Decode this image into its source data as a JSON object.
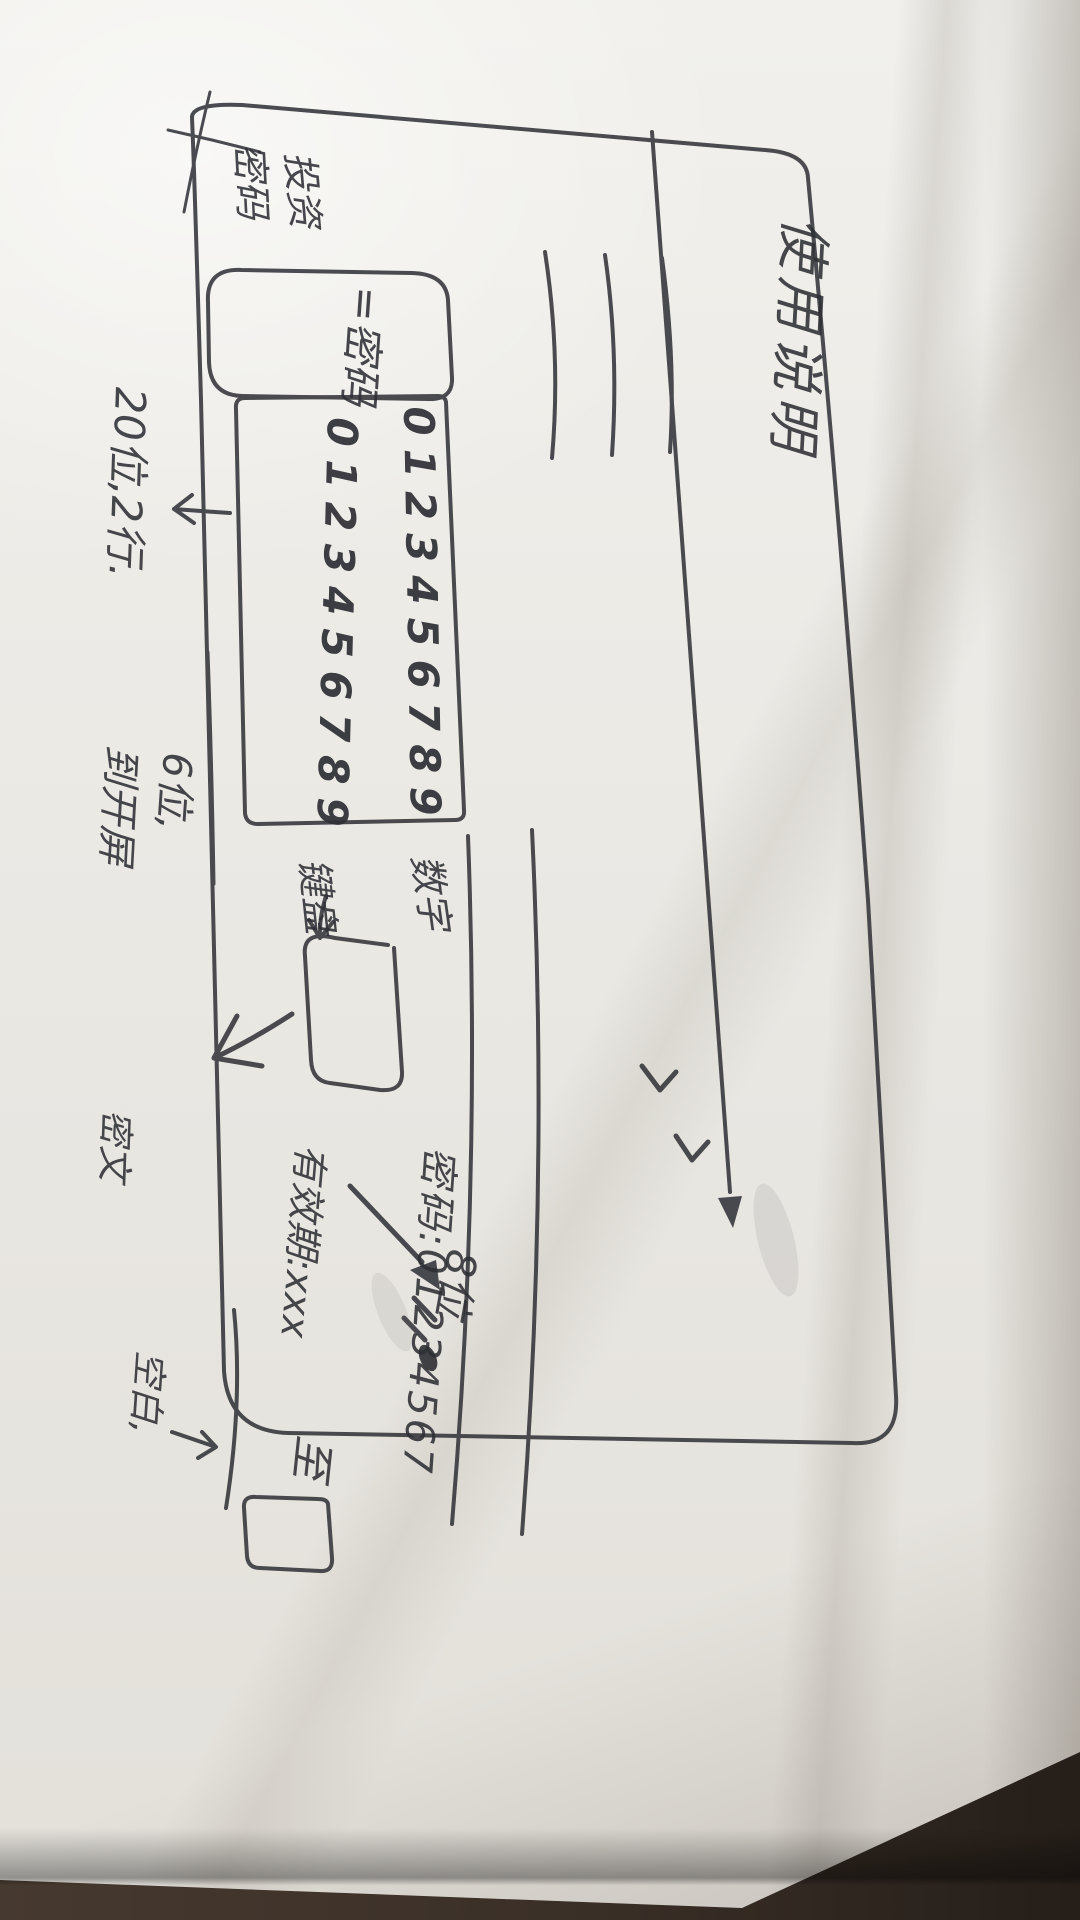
{
  "colors": {
    "floor": "#3a2f27",
    "paper": "#ebe9e4",
    "ink": "#2f3036"
  },
  "sketch": {
    "page_title": "使用说明",
    "content_placeholder_lines": 3,
    "password_section": {
      "label_row1": "投资",
      "label_row2": "密码",
      "field_label": "=密码"
    },
    "keypad": {
      "digits_row1": "0123456789",
      "digits_row2": "0123456789",
      "side_label_row1": "数字",
      "side_label_row2": "键盘"
    },
    "notes": {
      "keypad_size": "20位,2行.",
      "button_flow_row1": "6位,",
      "button_flow_row2": "到开屏",
      "password_example": "密码:01234567",
      "password_length": "8位",
      "validity": "有效期:xxx",
      "until": "至",
      "blank": "空白,",
      "masked": "密文"
    }
  }
}
